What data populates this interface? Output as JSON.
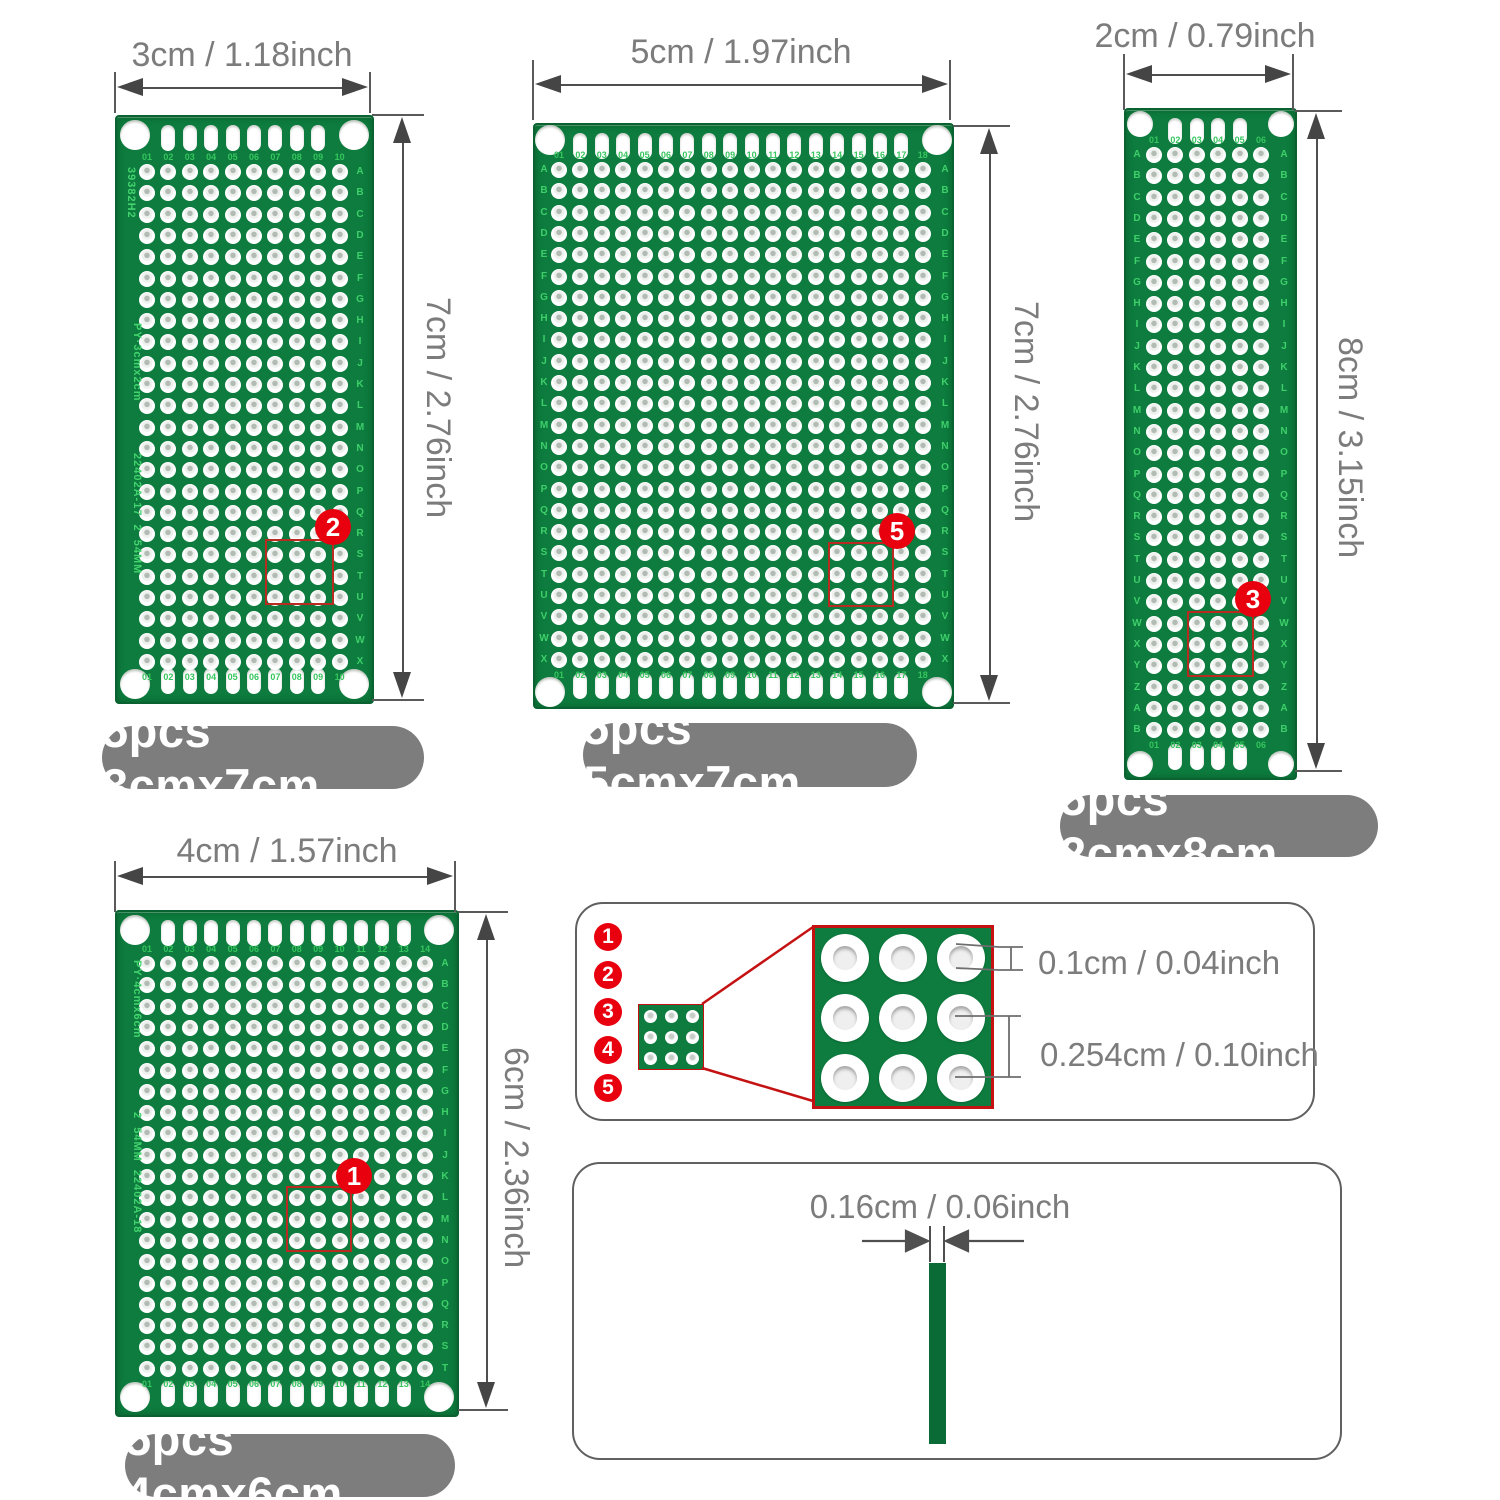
{
  "colors": {
    "pcb_green": "#0d7c3e",
    "silkscreen_green": "#43d36e",
    "marker_red": "#e8000f",
    "label_gray": "#7d7d7d",
    "dim_gray": "#7c7c7c"
  },
  "pitch": {
    "x": 21.4,
    "y": 21.3
  },
  "boards": [
    {
      "name": "3cmx7cm",
      "label": "5pcs 3cmx7cm",
      "x": 115,
      "y": 115,
      "w": 255,
      "h": 585,
      "cols": 10,
      "rows": 24,
      "gx": 30,
      "gy": 55,
      "letters": "ABCDEFGHIJKLMNOPQRSTUVWX",
      "letters_right": 236,
      "corner_inset": 18,
      "corner_dia": 30,
      "silkscreen": [
        {
          "text": "39382H2",
          "x": 8,
          "y": 50
        },
        {
          "text": "PY·3cmx2cm",
          "x": 14,
          "y": 206
        },
        {
          "text": "22402A-17  2  54MM",
          "x": 14,
          "y": 336
        }
      ],
      "marker": {
        "n": "2",
        "x": 333,
        "y": 527
      },
      "square": {
        "x": 265,
        "y": 539,
        "w": 65,
        "h": 62
      },
      "pill": {
        "x": 102,
        "y": 726,
        "w": 322,
        "h": 63
      },
      "dim_top": {
        "label": "3cm / 1.18inch",
        "x1": 115,
        "x2": 370,
        "y": 88,
        "t1": 72,
        "t2": 113,
        "lx": 242,
        "ly": 55
      },
      "dim_side": {
        "label": "7cm / 2.76inch",
        "x": 403,
        "y1": 115,
        "y2": 700,
        "t1": 372,
        "t2": 424,
        "lx": 438,
        "ly": 408
      }
    },
    {
      "name": "5cmx7cm",
      "label": "5pcs 5cmx7cm",
      "x": 533,
      "y": 123,
      "w": 417,
      "h": 582,
      "cols": 18,
      "rows": 24,
      "gx": 24,
      "gy": 45,
      "letters": "ABCDEFGHIJKLMNOPQRSTUVWX",
      "letters_left": 2,
      "letters_right": 403,
      "corner_inset": 15,
      "corner_dia": 30,
      "marker": {
        "n": "5",
        "x": 897,
        "y": 531
      },
      "square": {
        "x": 828,
        "y": 542,
        "w": 62,
        "h": 61
      },
      "pill": {
        "x": 583,
        "y": 723,
        "w": 334,
        "h": 64
      },
      "dim_top": {
        "label": "5cm / 1.97inch",
        "x1": 533,
        "x2": 950,
        "y": 85,
        "t1": 60,
        "t2": 120,
        "lx": 741,
        "ly": 52
      },
      "dim_side": {
        "label": "7cm / 2.76inch",
        "x": 990,
        "y1": 126,
        "y2": 703,
        "t1": 953,
        "t2": 1010,
        "lx": 1026,
        "ly": 412
      }
    },
    {
      "name": "2cmx8cm",
      "label": "5pcs 2cmx8cm",
      "x": 1124,
      "y": 108,
      "w": 169,
      "h": 668,
      "cols": 6,
      "rows": 28,
      "gx": 28,
      "gy": 45,
      "letters": "ABCDEFGHIJKLMNOPQRSTUVWXYZAB",
      "letters_left": 4,
      "letters_right": 151,
      "corner_inset": 14,
      "corner_dia": 26,
      "marker": {
        "n": "3",
        "x": 1253,
        "y": 599
      },
      "square": {
        "x": 1187,
        "y": 611,
        "w": 63,
        "h": 62
      },
      "pill": {
        "x": 1060,
        "y": 795,
        "w": 318,
        "h": 62
      },
      "dim_top": {
        "label": "2cm / 0.79inch",
        "x1": 1124,
        "x2": 1293,
        "y": 75,
        "t1": 54,
        "t2": 110,
        "lx": 1205,
        "ly": 36
      },
      "dim_side": {
        "label": "8cm / 3.15inch",
        "x": 1317,
        "y1": 111,
        "y2": 771,
        "t1": 1295,
        "t2": 1342,
        "lx": 1350,
        "ly": 448
      }
    },
    {
      "name": "4cmx6cm",
      "label": "5pcs 4cmx6cm",
      "x": 115,
      "y": 910,
      "w": 340,
      "h": 503,
      "cols": 14,
      "rows": 20,
      "gx": 30,
      "gy": 52,
      "letters": "ABCDEFGHIJKLMNOPQRST",
      "letters_right": 321,
      "corner_inset": 18,
      "corner_dia": 30,
      "silkscreen": [
        {
          "text": "PY·4cmx6cm",
          "x": 14,
          "y": 48
        },
        {
          "text": "2  54MM  22402A-18",
          "x": 14,
          "y": 200
        }
      ],
      "marker": {
        "n": "1",
        "x": 354,
        "y": 1176
      },
      "square": {
        "x": 286,
        "y": 1186,
        "w": 62,
        "h": 62
      },
      "pill": {
        "x": 125,
        "y": 1434,
        "w": 330,
        "h": 63
      },
      "dim_top": {
        "label": "4cm / 1.57inch",
        "x1": 115,
        "x2": 455,
        "y": 877,
        "t1": 861,
        "t2": 912,
        "lx": 287,
        "ly": 851
      },
      "dim_side": {
        "label": "6cm / 2.36inch",
        "x": 487,
        "y1": 912,
        "y2": 1410,
        "t1": 458,
        "t2": 508,
        "lx": 516,
        "ly": 1158
      }
    }
  ],
  "hole_detail": {
    "numbers": [
      "1",
      "2",
      "3",
      "4",
      "5"
    ],
    "hole_dim": "0.1cm / 0.04inch",
    "pitch_dim": "0.254cm / 0.10inch"
  },
  "thickness_detail": {
    "dim": "0.16cm / 0.06inch"
  }
}
